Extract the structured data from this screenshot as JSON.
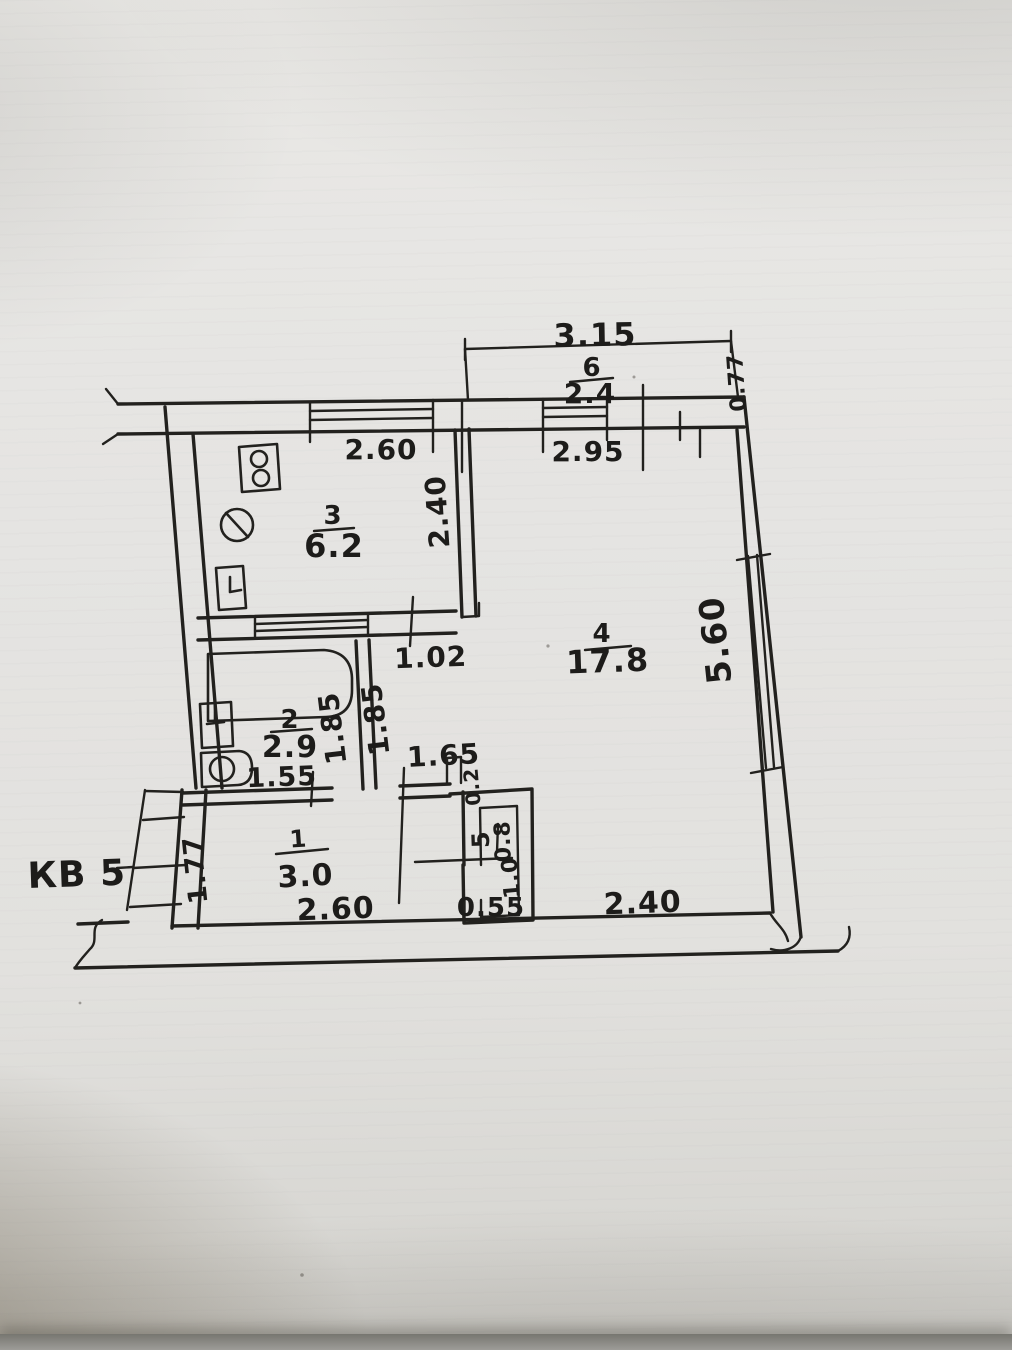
{
  "apartment": {
    "label": "КВ 5"
  },
  "rooms": {
    "balcony": {
      "number": "6",
      "area": "2.4"
    },
    "kitchen": {
      "number": "3",
      "area": "6.2"
    },
    "living": {
      "number": "4",
      "area": "17.8"
    },
    "bath": {
      "number": "2",
      "area": "2.9"
    },
    "hall": {
      "number": "1",
      "area": "3.0"
    },
    "closet": {
      "number": "5",
      "area": "0.8"
    }
  },
  "dims": {
    "balcony_width": "3.15",
    "balcony_depth": "0.77",
    "kitchen_window": "2.60",
    "living_window": "2.95",
    "kitchen_depth": "2.40",
    "kitchen_door": "1.02",
    "living_depth": "5.60",
    "living_width": "2.40",
    "bath_inner": "1.85",
    "corridor_inner": "1.85",
    "bath_width": "1.55",
    "niche_width": "1.65",
    "niche_stub": "0.2",
    "closet_depth": "1.0",
    "closet_width": "0.55",
    "hall_depth": "1.77",
    "hall_width": "2.60"
  },
  "colors": {
    "ink": "#22211e",
    "paper": "#e4e3e0"
  }
}
